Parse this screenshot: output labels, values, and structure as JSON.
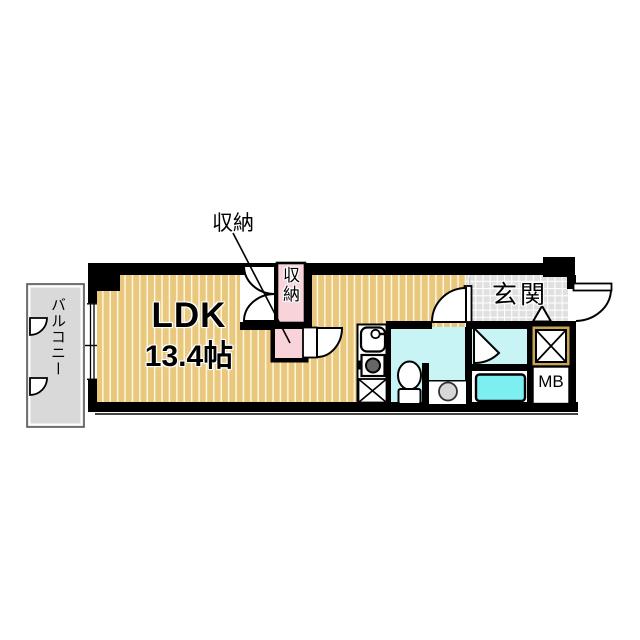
{
  "floorplan": {
    "rooms": {
      "ldk": {
        "label": "LDK",
        "size": "13.4帖"
      },
      "balcony": {
        "label": "バルコニー"
      },
      "entrance": {
        "label": "玄関"
      },
      "closet": {
        "label": "収納"
      },
      "storage_callout": {
        "label": "収納"
      },
      "meter_box": {
        "label": "MB"
      }
    },
    "colors": {
      "wall": "#000000",
      "ldk_floor": "#e9c87e",
      "ldk_stripe": "#fdf6e0",
      "closet_pink": "#f8d3d9",
      "wet_room_cyan": "#c9f4f6",
      "bathtub_cyan": "#7deef2",
      "balcony_gray": "#d9d9d9",
      "entrance_tile": "#e0e0e0",
      "tile_line": "#ffffff",
      "shaft_border_tan": "#c9a452",
      "fixture_gray": "#d7d7d7"
    }
  }
}
